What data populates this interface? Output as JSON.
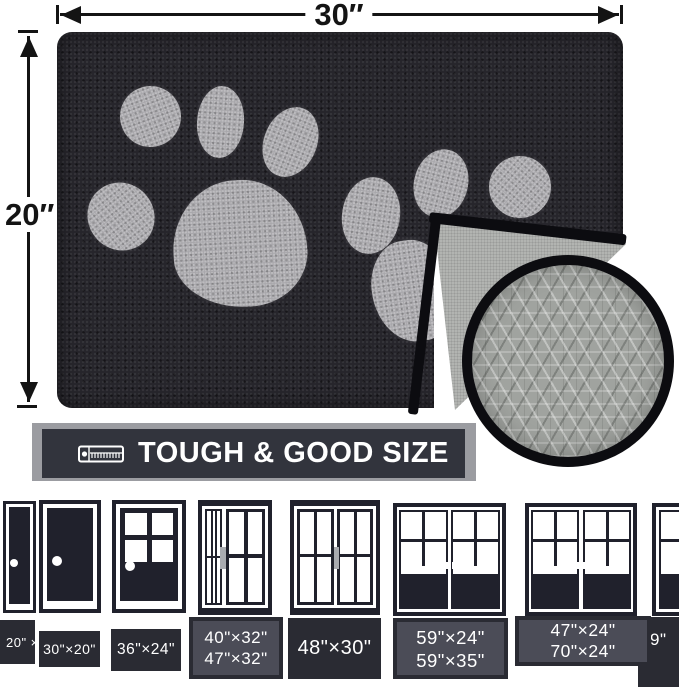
{
  "dimensions": {
    "width_label": "30″",
    "height_label": "20″"
  },
  "banner": {
    "text": "TOUGH & GOOD SIZE",
    "icon": "tape-measure-icon"
  },
  "mat": {
    "front_color_name": "black",
    "paw_motif": "two gray dog paw prints",
    "backing": "gray anti-slip diamond texture"
  },
  "doors": [
    {
      "type": "narrow solid door",
      "line1": "20\" ×"
    },
    {
      "type": "solid door",
      "line1": "30\"×20\""
    },
    {
      "type": "half-glass door",
      "line1": "36\"×24\""
    },
    {
      "type": "sliding door with sidelight",
      "line1": "40\"×32\"",
      "line2": "47\"×32\""
    },
    {
      "type": "sliding window",
      "line1": "48\"×30\""
    },
    {
      "type": "double french door",
      "line1": "59\"×24\"",
      "line2": "59\"×35\""
    },
    {
      "type": "double french door",
      "line1": "47\"×24\"",
      "line2": "70\"×24\""
    },
    {
      "type": "double french door (partial)",
      "line1": "9\""
    }
  ],
  "colors": {
    "ink": "#141414",
    "mat-dark": "#26252b",
    "paw-gray": "#a8a7ab",
    "back-gray": "#b2b4b1",
    "ring-black": "#0c0c10",
    "banner-dark": "#32343d",
    "banner-shadow": "#9b9ca1",
    "door-dark": "#20212c",
    "label-dark": "#2a2b33",
    "label-light": "#4b4c57"
  }
}
